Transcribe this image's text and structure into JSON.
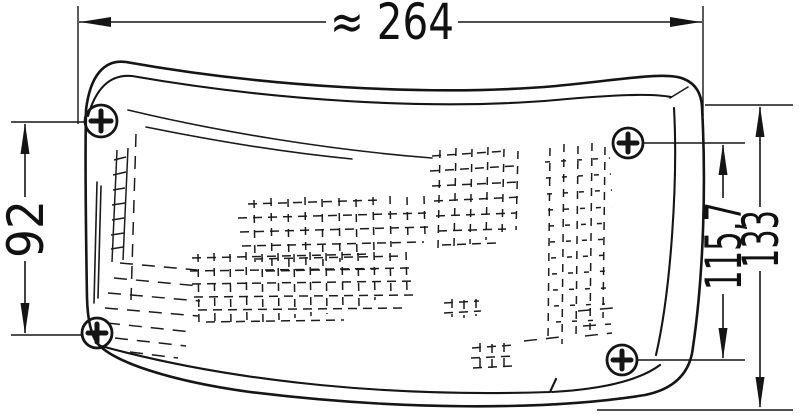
{
  "drawing": {
    "type": "technical-dimension-drawing",
    "colors": {
      "ink": "#151515",
      "background": "#ffffff"
    },
    "dimensions": {
      "width": "≈ 264",
      "left_height": "92",
      "right_inner_height": "115,7",
      "right_outer_height": "133"
    }
  }
}
